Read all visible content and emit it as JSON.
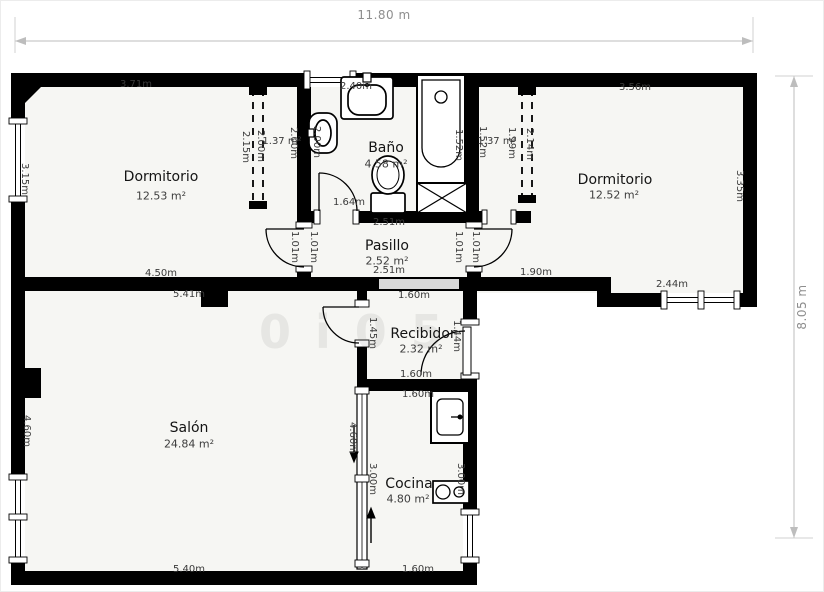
{
  "overall_dimensions": {
    "width_label": "11.80 m",
    "height_label": "8.05 m"
  },
  "watermark": "0i05",
  "colors": {
    "wall": "#000000",
    "interior": "#f6f6f3",
    "glazing_panel": "#d8d8d8",
    "dim_text": "#3a3a3a",
    "overall_dim_text": "#8e8e8e",
    "room_text": "#141414"
  },
  "rooms": [
    {
      "name": "Dormitorio",
      "area": "12.53 m²",
      "nx": 160,
      "ny": 176,
      "ax": 160,
      "ay": 195
    },
    {
      "name": "Baño",
      "area": "4.58 m²",
      "nx": 385,
      "ny": 147,
      "ax": 385,
      "ay": 163
    },
    {
      "name": "Dormitorio",
      "area": "12.52 m²",
      "nx": 614,
      "ny": 179,
      "ax": 613,
      "ay": 194
    },
    {
      "name": "Pasillo",
      "area": "2.52 m²",
      "nx": 386,
      "ny": 245,
      "ax": 386,
      "ay": 260
    },
    {
      "name": "Recibidor",
      "area": "2.32 m²",
      "nx": 422,
      "ny": 333,
      "ax": 420,
      "ay": 348
    },
    {
      "name": "Salón",
      "area": "24.84 m²",
      "nx": 188,
      "ny": 427,
      "ax": 188,
      "ay": 443
    },
    {
      "name": "Cocina",
      "area": "4.80 m²",
      "nx": 408,
      "ny": 483,
      "ax": 407,
      "ay": 498
    }
  ],
  "dim_labels": [
    {
      "text": "11.80 m",
      "x": 383,
      "y": 14,
      "rot": 0,
      "style": "overall"
    },
    {
      "text": "8.05 m",
      "x": 801,
      "y": 306,
      "rot": -90,
      "style": "overall"
    },
    {
      "text": "3.71m",
      "x": 135,
      "y": 84,
      "rot": 0
    },
    {
      "text": "2.40m",
      "x": 355,
      "y": 86,
      "rot": 0
    },
    {
      "text": "3.56m",
      "x": 634,
      "y": 87,
      "rot": 0
    },
    {
      "text": "1.37 m²",
      "x": 281,
      "y": 141,
      "rot": 0
    },
    {
      "text": "1.37 m²",
      "x": 496,
      "y": 141,
      "rot": 0
    },
    {
      "text": "1.64m",
      "x": 348,
      "y": 202,
      "rot": 0
    },
    {
      "text": "2.51m",
      "x": 388,
      "y": 222,
      "rot": 0
    },
    {
      "text": "2.51m",
      "x": 388,
      "y": 270,
      "rot": 0
    },
    {
      "text": "4.50m",
      "x": 160,
      "y": 273,
      "rot": 0
    },
    {
      "text": "1.90m",
      "x": 535,
      "y": 272,
      "rot": 0
    },
    {
      "text": "2.44m",
      "x": 671,
      "y": 284,
      "rot": 0
    },
    {
      "text": "5.41m",
      "x": 188,
      "y": 294,
      "rot": 0
    },
    {
      "text": "1.60m",
      "x": 413,
      "y": 295,
      "rot": 0
    },
    {
      "text": "1.60m",
      "x": 415,
      "y": 374,
      "rot": 0
    },
    {
      "text": "1.60m",
      "x": 417,
      "y": 394,
      "rot": 0
    },
    {
      "text": "1.60m",
      "x": 417,
      "y": 569,
      "rot": 0
    },
    {
      "text": "5.40m",
      "x": 188,
      "y": 569,
      "rot": 0
    },
    {
      "text": "3.15m",
      "x": 23,
      "y": 178,
      "rot": 90
    },
    {
      "text": "2.15m",
      "x": 244,
      "y": 146,
      "rot": 90
    },
    {
      "text": "2.00m",
      "x": 259,
      "y": 145,
      "rot": 90
    },
    {
      "text": "2.00m",
      "x": 292,
      "y": 142,
      "rot": 90
    },
    {
      "text": "2.00m",
      "x": 315,
      "y": 141,
      "rot": 90
    },
    {
      "text": "1.52m",
      "x": 457,
      "y": 144,
      "rot": 90
    },
    {
      "text": "1.52m",
      "x": 481,
      "y": 141,
      "rot": 90
    },
    {
      "text": "1.99m",
      "x": 510,
      "y": 142,
      "rot": 90
    },
    {
      "text": "2.14m",
      "x": 528,
      "y": 143,
      "rot": 90
    },
    {
      "text": "3.35m",
      "x": 738,
      "y": 185,
      "rot": 90
    },
    {
      "text": "1.01m",
      "x": 293,
      "y": 246,
      "rot": 90
    },
    {
      "text": "1.01m",
      "x": 312,
      "y": 246,
      "rot": 90
    },
    {
      "text": "1.01m",
      "x": 457,
      "y": 246,
      "rot": 90
    },
    {
      "text": "1.01m",
      "x": 474,
      "y": 246,
      "rot": 90
    },
    {
      "text": "1.45m",
      "x": 371,
      "y": 332,
      "rot": 90
    },
    {
      "text": "1.44m",
      "x": 455,
      "y": 335,
      "rot": 90
    },
    {
      "text": "4.60m",
      "x": 25,
      "y": 430,
      "rot": 90
    },
    {
      "text": "4.60m",
      "x": 351,
      "y": 437,
      "rot": 90
    },
    {
      "text": "3.00m",
      "x": 371,
      "y": 478,
      "rot": 90
    },
    {
      "text": "3.00m",
      "x": 459,
      "y": 478,
      "rot": 90
    }
  ]
}
